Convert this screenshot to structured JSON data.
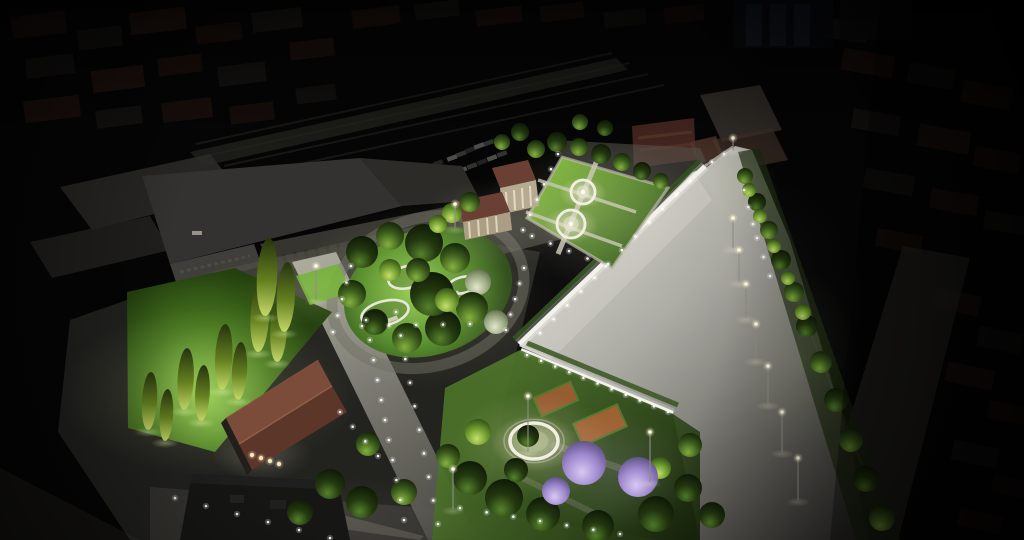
{
  "meta": {
    "alt": "Night aerial architectural rendering of an illuminated urban park and plaza beside a railway station, surrounded by a dark city",
    "canvas": {
      "w": 1024,
      "h": 540
    }
  },
  "palette": {
    "bg": "#050505",
    "city_roof": "#4a281c",
    "city_wall": "#3b362f",
    "city_pale": "#555048",
    "rail": "#26251f",
    "band": "#f2f1e9",
    "hedge": "#304d19",
    "lamp_pole": "#8e8e86",
    "light_dot": "#ffffff",
    "terracotta": "#9a5a30",
    "brick": "#5a3028",
    "plaza_bright": "#d6d5cd",
    "lawn_bright": "#8fc94b",
    "jacaranda": "#9d88cc",
    "fountain_rim": "#f1efe4",
    "pavilion_roof": "#7b4c39",
    "warm_light": "#ffe9c0"
  },
  "scene": {
    "city_blocks": [
      [
        12,
        14,
        54,
        22,
        -7,
        "r",
        0.38
      ],
      [
        78,
        28,
        44,
        20,
        -7,
        "w",
        0.3
      ],
      [
        130,
        10,
        56,
        22,
        -7,
        "r",
        0.42
      ],
      [
        196,
        24,
        46,
        18,
        -7,
        "r",
        0.3
      ],
      [
        252,
        10,
        50,
        20,
        -7,
        "w",
        0.32
      ],
      [
        26,
        56,
        48,
        20,
        -7,
        "w",
        0.3
      ],
      [
        92,
        68,
        52,
        22,
        -7,
        "r",
        0.4
      ],
      [
        158,
        56,
        44,
        18,
        -7,
        "r",
        0.33
      ],
      [
        218,
        64,
        48,
        20,
        -7,
        "w",
        0.28
      ],
      [
        24,
        98,
        56,
        22,
        -7,
        "r",
        0.35
      ],
      [
        96,
        108,
        46,
        18,
        -7,
        "w",
        0.3
      ],
      [
        162,
        100,
        50,
        20,
        -7,
        "r",
        0.3
      ],
      [
        230,
        104,
        44,
        18,
        -7,
        "r",
        0.26
      ],
      [
        290,
        40,
        44,
        18,
        -7,
        "r",
        0.3
      ],
      [
        296,
        86,
        40,
        16,
        -7,
        "w",
        0.24
      ],
      [
        352,
        8,
        48,
        18,
        -7,
        "r",
        0.3
      ],
      [
        415,
        2,
        44,
        16,
        -7,
        "w",
        0.26
      ],
      [
        476,
        8,
        46,
        16,
        -7,
        "r",
        0.28
      ],
      [
        540,
        4,
        44,
        16,
        -7,
        "r",
        0.24
      ],
      [
        604,
        10,
        42,
        16,
        -7,
        "w",
        0.22
      ],
      [
        664,
        6,
        40,
        16,
        -7,
        "r",
        0.22
      ],
      [
        842,
        52,
        52,
        22,
        10,
        "r",
        0.35
      ],
      [
        908,
        66,
        46,
        20,
        10,
        "w",
        0.28
      ],
      [
        962,
        84,
        50,
        22,
        10,
        "r",
        0.38
      ],
      [
        852,
        112,
        48,
        20,
        10,
        "w",
        0.3
      ],
      [
        918,
        128,
        52,
        22,
        10,
        "r",
        0.4
      ],
      [
        974,
        150,
        46,
        20,
        10,
        "r",
        0.33
      ],
      [
        864,
        172,
        50,
        20,
        10,
        "w",
        0.28
      ],
      [
        930,
        192,
        48,
        20,
        10,
        "r",
        0.36
      ],
      [
        984,
        214,
        44,
        18,
        10,
        "w",
        0.3
      ],
      [
        876,
        232,
        46,
        18,
        10,
        "r",
        0.3
      ],
      [
        934,
        292,
        46,
        20,
        12,
        "r",
        0.32
      ],
      [
        978,
        330,
        44,
        20,
        12,
        "w",
        0.26
      ],
      [
        946,
        366,
        48,
        20,
        12,
        "r",
        0.34
      ],
      [
        988,
        404,
        42,
        18,
        12,
        "r",
        0.3
      ],
      [
        952,
        444,
        46,
        20,
        12,
        "w",
        0.26
      ],
      [
        992,
        478,
        42,
        18,
        12,
        "r",
        0.3
      ],
      [
        958,
        512,
        44,
        18,
        12,
        "r",
        0.28
      ],
      [
        820,
        20,
        48,
        20,
        8,
        "p",
        0.2
      ]
    ],
    "rail_lines": [
      [
        196,
        144,
        612,
        53
      ],
      [
        210,
        155,
        630,
        63
      ],
      [
        224,
        166,
        648,
        74
      ],
      [
        240,
        177,
        664,
        85
      ]
    ],
    "cars": [
      [
        452,
        158
      ],
      [
        461,
        154
      ],
      [
        470,
        150
      ],
      [
        479,
        146
      ],
      [
        488,
        143
      ],
      [
        497,
        140
      ],
      [
        462,
        170
      ],
      [
        472,
        166
      ],
      [
        482,
        162
      ],
      [
        492,
        158
      ],
      [
        502,
        154
      ],
      [
        438,
        163
      ]
    ],
    "car_colors": [
      "#97968f",
      "#62625e",
      "#3e3e40"
    ],
    "glows": [
      [
        210,
        392,
        150,
        85,
        "green",
        0.2
      ],
      [
        300,
        290,
        55,
        35,
        "green",
        0.14
      ],
      [
        425,
        295,
        130,
        95,
        "green",
        0.17
      ],
      [
        592,
        212,
        112,
        72,
        "warm",
        0.16
      ],
      [
        534,
        446,
        80,
        55,
        "warm",
        0.22
      ],
      [
        612,
        472,
        85,
        60,
        "purple",
        0.16
      ],
      [
        495,
        222,
        75,
        45,
        "warm",
        0.12
      ],
      [
        660,
        300,
        210,
        160,
        "white",
        0.06
      ],
      [
        262,
        455,
        50,
        26,
        "warm",
        0.18
      ],
      [
        320,
        515,
        150,
        40,
        "white",
        0.06
      ],
      [
        740,
        190,
        40,
        40,
        "green",
        0.1
      ],
      [
        800,
        360,
        60,
        90,
        "green",
        0.08
      ]
    ],
    "light_rows": [
      [
        540,
        333,
        690,
        181,
        12
      ],
      [
        712,
        162,
        724,
        154,
        2
      ],
      [
        527,
        355,
        668,
        412,
        11
      ],
      [
        366,
        320,
        404,
        520,
        11
      ],
      [
        396,
        312,
        438,
        524,
        10
      ],
      [
        175,
        498,
        330,
        538,
        6
      ],
      [
        460,
        508,
        620,
        534,
        7
      ],
      [
        340,
        412,
        378,
        456,
        4
      ],
      [
        333,
        332,
        351,
        266,
        5
      ],
      [
        506,
        330,
        524,
        268,
        5
      ],
      [
        523,
        230,
        558,
        154,
        6
      ],
      [
        532,
        236,
        606,
        266,
        5
      ],
      [
        362,
        326,
        470,
        324,
        5
      ],
      [
        744,
        190,
        753,
        224,
        3
      ],
      [
        757,
        238,
        770,
        276,
        3
      ]
    ],
    "lamps": [
      [
        733,
        150,
        12
      ],
      [
        733,
        248,
        30
      ],
      [
        739,
        282,
        32
      ],
      [
        746,
        318,
        34
      ],
      [
        756,
        360,
        36
      ],
      [
        768,
        404,
        38
      ],
      [
        782,
        452,
        40
      ],
      [
        798,
        500,
        42
      ],
      [
        528,
        452,
        56
      ],
      [
        650,
        482,
        50
      ],
      [
        453,
        509,
        40
      ],
      [
        316,
        300,
        34
      ],
      [
        455,
        228,
        24
      ]
    ],
    "fountains": [
      [
        583,
        192,
        12,
        "jet"
      ],
      [
        571,
        224,
        14,
        "jet"
      ],
      [
        534,
        441,
        24,
        "pool"
      ]
    ],
    "planters": [
      [
        408,
        277,
        20,
        11,
        -14
      ],
      [
        385,
        313,
        24,
        12,
        -14
      ],
      [
        463,
        285,
        16,
        8,
        -14
      ]
    ],
    "benches": [
      [
        390,
        320,
        16,
        4,
        -20
      ]
    ],
    "pavilion_lights": [
      [
        252,
        455
      ],
      [
        261,
        458
      ],
      [
        270,
        461
      ],
      [
        279,
        464
      ]
    ],
    "cypresses": [
      [
        148,
        430,
        58
      ],
      [
        165,
        441,
        52
      ],
      [
        184,
        410,
        62
      ],
      [
        201,
        421,
        56
      ],
      [
        222,
        390,
        66
      ],
      [
        238,
        400,
        58
      ],
      [
        258,
        352,
        72
      ],
      [
        277,
        362,
        64
      ],
      [
        265,
        316,
        78
      ],
      [
        284,
        332,
        70
      ]
    ],
    "trees": [
      [
        362,
        252,
        16,
        "d"
      ],
      [
        390,
        236,
        14,
        "m"
      ],
      [
        424,
        243,
        19,
        "d"
      ],
      [
        455,
        258,
        15,
        "m"
      ],
      [
        478,
        282,
        13,
        "p"
      ],
      [
        472,
        308,
        16,
        "m"
      ],
      [
        443,
        328,
        18,
        "d"
      ],
      [
        407,
        338,
        15,
        "m"
      ],
      [
        375,
        322,
        13,
        "d"
      ],
      [
        352,
        294,
        14,
        "m"
      ],
      [
        432,
        294,
        22,
        "d"
      ],
      [
        390,
        270,
        11,
        "b"
      ],
      [
        447,
        300,
        12,
        "b"
      ],
      [
        496,
        322,
        12,
        "p"
      ],
      [
        418,
        270,
        12,
        "m"
      ],
      [
        536,
        149,
        9,
        "m"
      ],
      [
        557,
        142,
        10,
        "d"
      ],
      [
        579,
        147,
        9,
        "m"
      ],
      [
        601,
        154,
        10,
        "d"
      ],
      [
        622,
        162,
        9,
        "m"
      ],
      [
        642,
        171,
        9,
        "d"
      ],
      [
        661,
        181,
        8,
        "m"
      ],
      [
        605,
        128,
        8,
        "d"
      ],
      [
        580,
        122,
        8,
        "m"
      ],
      [
        452,
        213,
        10,
        "b"
      ],
      [
        470,
        202,
        10,
        "m"
      ],
      [
        438,
        224,
        9,
        "b"
      ],
      [
        520,
        132,
        9,
        "d"
      ],
      [
        502,
        142,
        8,
        "m"
      ],
      [
        470,
        478,
        17,
        "d"
      ],
      [
        504,
        498,
        19,
        "d"
      ],
      [
        543,
        514,
        17,
        "d"
      ],
      [
        598,
        526,
        16,
        "d"
      ],
      [
        656,
        514,
        18,
        "d"
      ],
      [
        688,
        488,
        14,
        "d"
      ],
      [
        478,
        432,
        13,
        "b"
      ],
      [
        448,
        456,
        12,
        "m"
      ],
      [
        516,
        470,
        12,
        "d"
      ],
      [
        660,
        468,
        11,
        "b"
      ],
      [
        690,
        445,
        12,
        "m"
      ],
      [
        528,
        436,
        11,
        "d"
      ],
      [
        712,
        515,
        13,
        "d"
      ],
      [
        584,
        463,
        22,
        "j"
      ],
      [
        638,
        477,
        20,
        "j"
      ],
      [
        556,
        491,
        14,
        "j"
      ],
      [
        745,
        176,
        8,
        "m"
      ],
      [
        757,
        202,
        9,
        "d"
      ],
      [
        769,
        230,
        9,
        "m"
      ],
      [
        781,
        260,
        10,
        "d"
      ],
      [
        794,
        292,
        10,
        "m"
      ],
      [
        807,
        326,
        11,
        "d"
      ],
      [
        821,
        362,
        11,
        "m"
      ],
      [
        836,
        400,
        12,
        "d"
      ],
      [
        851,
        440,
        12,
        "m"
      ],
      [
        866,
        479,
        13,
        "d"
      ],
      [
        882,
        518,
        13,
        "m"
      ],
      [
        749,
        190,
        7,
        "b"
      ],
      [
        760,
        216,
        7,
        "b"
      ],
      [
        774,
        246,
        7,
        "b"
      ],
      [
        788,
        278,
        7,
        "b"
      ],
      [
        803,
        312,
        8,
        "b"
      ],
      [
        330,
        484,
        15,
        "d"
      ],
      [
        362,
        502,
        16,
        "d"
      ],
      [
        300,
        512,
        13,
        "d"
      ],
      [
        368,
        444,
        12,
        "m"
      ],
      [
        404,
        492,
        13,
        "m"
      ]
    ]
  }
}
